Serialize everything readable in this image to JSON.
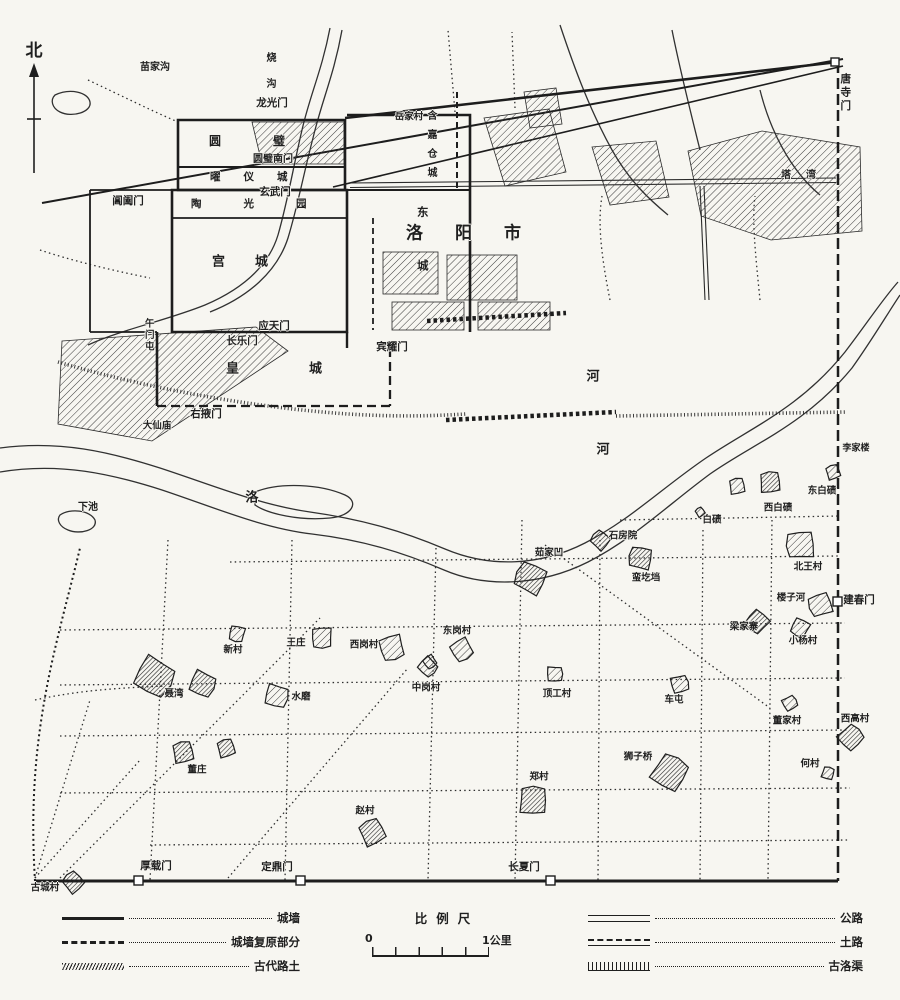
{
  "palette": {
    "ink": "#1f1f1f",
    "paper": "#f7f6f1"
  },
  "compass": {
    "label": "北"
  },
  "map": {
    "labels": [
      {
        "name": "miaojiagou",
        "text": "苗家沟",
        "x": 155,
        "y": 68,
        "size": 10
      },
      {
        "name": "shaogou",
        "text": "烧沟",
        "x": 269,
        "y": 52,
        "size": 10,
        "v": true,
        "ls": 16
      },
      {
        "name": "longguangmen",
        "text": "龙光门",
        "x": 272,
        "y": 103,
        "size": 10.5
      },
      {
        "name": "yuanbicheng",
        "text": "圆璧",
        "x": 209,
        "y": 141,
        "size": 12,
        "sp": true,
        "ls": 52
      },
      {
        "name": "yuanbi-nanmen",
        "text": "圆璧南门",
        "x": 273,
        "y": 160,
        "size": 10
      },
      {
        "name": "yaoyicheng",
        "text": "曜仪城",
        "x": 210,
        "y": 177,
        "size": 10.5,
        "sp": true,
        "ls": 23
      },
      {
        "name": "xuanwumen",
        "text": "玄武门",
        "x": 275,
        "y": 192,
        "size": 10.5
      },
      {
        "name": "changhemen",
        "text": "阊阖门",
        "x": 128,
        "y": 201,
        "size": 10.5
      },
      {
        "name": "taoguangyuan",
        "text": "陶光园",
        "x": 191,
        "y": 204,
        "size": 10.5,
        "sp": true,
        "ls": 42
      },
      {
        "name": "yuejiacun",
        "text": "岳家村",
        "x": 409,
        "y": 117,
        "size": 9.5
      },
      {
        "name": "hanjia-cangcheng",
        "text": "含嘉仓城",
        "x": 430,
        "y": 110,
        "size": 10,
        "v": true,
        "ls": 9
      },
      {
        "name": "tawan",
        "text": "塔湾",
        "x": 781,
        "y": 176,
        "size": 10,
        "sp": true,
        "ls": 15
      },
      {
        "name": "tangsimen",
        "text": "唐寺门",
        "x": 845,
        "y": 73,
        "size": 10.5,
        "v": true,
        "ls": 3
      },
      {
        "name": "gongcheng",
        "text": "宫城",
        "x": 212,
        "y": 262,
        "size": 13,
        "sp": true,
        "ls": 30
      },
      {
        "name": "dongcheng",
        "text": "东城",
        "x": 422,
        "y": 206,
        "size": 11.5,
        "v": true,
        "ls": 42
      },
      {
        "name": "luoyang-shi",
        "text": "洛阳市",
        "x": 406,
        "y": 234,
        "size": 17,
        "sp": true,
        "ls": 32
      },
      {
        "name": "yingtianmen",
        "text": "应天门",
        "x": 274,
        "y": 326,
        "size": 10.5
      },
      {
        "name": "changlemen",
        "text": "长乐门",
        "x": 242,
        "y": 341,
        "size": 10.5
      },
      {
        "name": "binyaomen",
        "text": "宾耀门",
        "x": 392,
        "y": 347,
        "size": 10.5
      },
      {
        "name": "huangcheng",
        "text": "皇城",
        "x": 226,
        "y": 369,
        "size": 13,
        "sp": true,
        "ls": 70
      },
      {
        "name": "youyemen",
        "text": "右掖门",
        "x": 206,
        "y": 414,
        "size": 10.5
      },
      {
        "name": "wumentun",
        "text": "午门屯",
        "x": 148,
        "y": 318,
        "size": 9.5,
        "v": true,
        "ls": 2
      },
      {
        "name": "daxianmiao",
        "text": "大仙庙",
        "x": 157,
        "y": 426,
        "size": 9.5
      },
      {
        "name": "xiachi",
        "text": "下池",
        "x": 88,
        "y": 508,
        "size": 10
      },
      {
        "name": "luo-river-char-luo",
        "text": "洛",
        "x": 252,
        "y": 498,
        "size": 13
      },
      {
        "name": "luo-river-char-he-1",
        "text": "河",
        "x": 593,
        "y": 377,
        "size": 13
      },
      {
        "name": "luo-river-char-he-2",
        "text": "河",
        "x": 603,
        "y": 450,
        "size": 13
      },
      {
        "name": "lijialou",
        "text": "李家楼",
        "x": 856,
        "y": 449,
        "size": 9
      },
      {
        "name": "xibaiqi",
        "text": "西白碛",
        "x": 778,
        "y": 508,
        "size": 9.5,
        "blobs": [
          [
            770,
            482,
            12,
            1
          ],
          [
            737,
            486,
            9,
            0
          ]
        ]
      },
      {
        "name": "dongbaiqi",
        "text": "东白碛",
        "x": 822,
        "y": 491,
        "size": 9.5,
        "blobs": [
          [
            833,
            472,
            8,
            0
          ]
        ]
      },
      {
        "name": "baiqi",
        "text": "白碛",
        "x": 712,
        "y": 520,
        "size": 9.5,
        "blobs": [
          [
            700,
            512,
            5,
            0
          ]
        ]
      },
      {
        "name": "shifangyuan",
        "text": "石房院",
        "x": 623,
        "y": 536,
        "size": 9.5,
        "blobs": [
          [
            600,
            540,
            10,
            1
          ]
        ]
      },
      {
        "name": "rujiawa",
        "text": "茹家凹",
        "x": 549,
        "y": 553,
        "size": 9.5,
        "blobs": [
          [
            530,
            578,
            17,
            1
          ]
        ]
      },
      {
        "name": "mangedang",
        "text": "蛮圪垱",
        "x": 646,
        "y": 578,
        "size": 9.5,
        "blobs": [
          [
            640,
            558,
            13,
            1
          ]
        ]
      },
      {
        "name": "beiwangcun",
        "text": "北王村",
        "x": 808,
        "y": 567,
        "size": 9.5,
        "blobs": [
          [
            800,
            545,
            16,
            0
          ]
        ]
      },
      {
        "name": "louzihe",
        "text": "楼子河",
        "x": 791,
        "y": 598,
        "size": 9.5,
        "blobs": [
          [
            820,
            605,
            13,
            0
          ]
        ]
      },
      {
        "name": "jianchunmen",
        "text": "建春门",
        "x": 859,
        "y": 600,
        "size": 10.5
      },
      {
        "name": "liangjiazhai",
        "text": "梁家寨",
        "x": 744,
        "y": 627,
        "size": 9.5,
        "blobs": [
          [
            757,
            622,
            12,
            1
          ]
        ]
      },
      {
        "name": "xiaoyangcun",
        "text": "小杨村",
        "x": 803,
        "y": 641,
        "size": 9.5,
        "blobs": [
          [
            800,
            628,
            10,
            0
          ]
        ]
      },
      {
        "name": "xincun",
        "text": "新村",
        "x": 233,
        "y": 650,
        "size": 9.5,
        "blobs": [
          [
            237,
            634,
            9,
            0
          ]
        ]
      },
      {
        "name": "wangzhuang",
        "text": "王庄",
        "x": 296,
        "y": 643,
        "size": 9.5,
        "blobs": [
          [
            322,
            638,
            12,
            0
          ]
        ]
      },
      {
        "name": "xigangcun",
        "text": "西岗村",
        "x": 364,
        "y": 645,
        "size": 9.5,
        "blobs": [
          [
            392,
            648,
            14,
            0
          ]
        ]
      },
      {
        "name": "donggangcun",
        "text": "东岗村",
        "x": 457,
        "y": 631,
        "size": 9.5,
        "blobs": [
          [
            462,
            650,
            12,
            0
          ],
          [
            430,
            662,
            7,
            0
          ]
        ]
      },
      {
        "name": "zhonggangcun",
        "text": "中岗村",
        "x": 426,
        "y": 688,
        "size": 9.5,
        "blobs": [
          [
            428,
            667,
            10,
            0
          ]
        ]
      },
      {
        "name": "niewan",
        "text": "聂湾",
        "x": 174,
        "y": 694,
        "size": 9.5,
        "blobs": [
          [
            155,
            677,
            21,
            1
          ],
          [
            203,
            684,
            14,
            1
          ]
        ]
      },
      {
        "name": "shuimo",
        "text": "水磨",
        "x": 301,
        "y": 697,
        "size": 9.5,
        "blobs": [
          [
            277,
            696,
            13,
            0
          ]
        ]
      },
      {
        "name": "dinggongcun",
        "text": "顶工村",
        "x": 557,
        "y": 694,
        "size": 9.5,
        "blobs": [
          [
            555,
            674,
            9,
            0
          ]
        ]
      },
      {
        "name": "chetun",
        "text": "车屯",
        "x": 674,
        "y": 700,
        "size": 9.5,
        "blobs": [
          [
            680,
            684,
            10,
            0
          ]
        ]
      },
      {
        "name": "dongjiacun",
        "text": "董家村",
        "x": 787,
        "y": 721,
        "size": 9.5,
        "blobs": [
          [
            790,
            703,
            8,
            0
          ]
        ]
      },
      {
        "name": "xigaocun",
        "text": "西高村",
        "x": 855,
        "y": 719,
        "size": 9.5,
        "blobs": [
          [
            851,
            737,
            13,
            1
          ]
        ]
      },
      {
        "name": "shiziqiao",
        "text": "狮子桥",
        "x": 638,
        "y": 757,
        "size": 9.5,
        "blobs": [
          [
            670,
            772,
            19,
            1
          ]
        ]
      },
      {
        "name": "hecun",
        "text": "何村",
        "x": 810,
        "y": 764,
        "size": 9.5,
        "blobs": [
          [
            828,
            773,
            7,
            0
          ]
        ]
      },
      {
        "name": "zhengcun",
        "text": "郑村",
        "x": 539,
        "y": 777,
        "size": 9.5,
        "blobs": [
          [
            533,
            800,
            16,
            1
          ]
        ]
      },
      {
        "name": "dongzhuang",
        "text": "董庄",
        "x": 197,
        "y": 770,
        "size": 9.5,
        "blobs": [
          [
            183,
            752,
            12,
            1
          ],
          [
            226,
            748,
            10,
            1
          ]
        ]
      },
      {
        "name": "zhaocun",
        "text": "赵村",
        "x": 365,
        "y": 811,
        "size": 9.5,
        "blobs": [
          [
            372,
            832,
            14,
            1
          ]
        ]
      },
      {
        "name": "guchengcun",
        "text": "古城村",
        "x": 45,
        "y": 888,
        "size": 9.5,
        "blobs": [
          [
            73,
            882,
            11,
            1
          ]
        ]
      },
      {
        "name": "houzaimen",
        "text": "厚载门",
        "x": 156,
        "y": 866,
        "size": 10.5
      },
      {
        "name": "dingdingmen",
        "text": "定鼎门",
        "x": 277,
        "y": 867,
        "size": 10.5
      },
      {
        "name": "changxiamen",
        "text": "长夏门",
        "x": 524,
        "y": 867,
        "size": 10.5
      }
    ]
  },
  "legend": {
    "left": [
      {
        "label": "城墙"
      },
      {
        "label": "城墙复原部分"
      },
      {
        "label": "古代路土"
      }
    ],
    "scale": {
      "title": "比例尺",
      "start": "0",
      "end": "1公里"
    },
    "right": [
      {
        "label": "公路"
      },
      {
        "label": "土路"
      },
      {
        "label": "古洛渠"
      }
    ]
  }
}
